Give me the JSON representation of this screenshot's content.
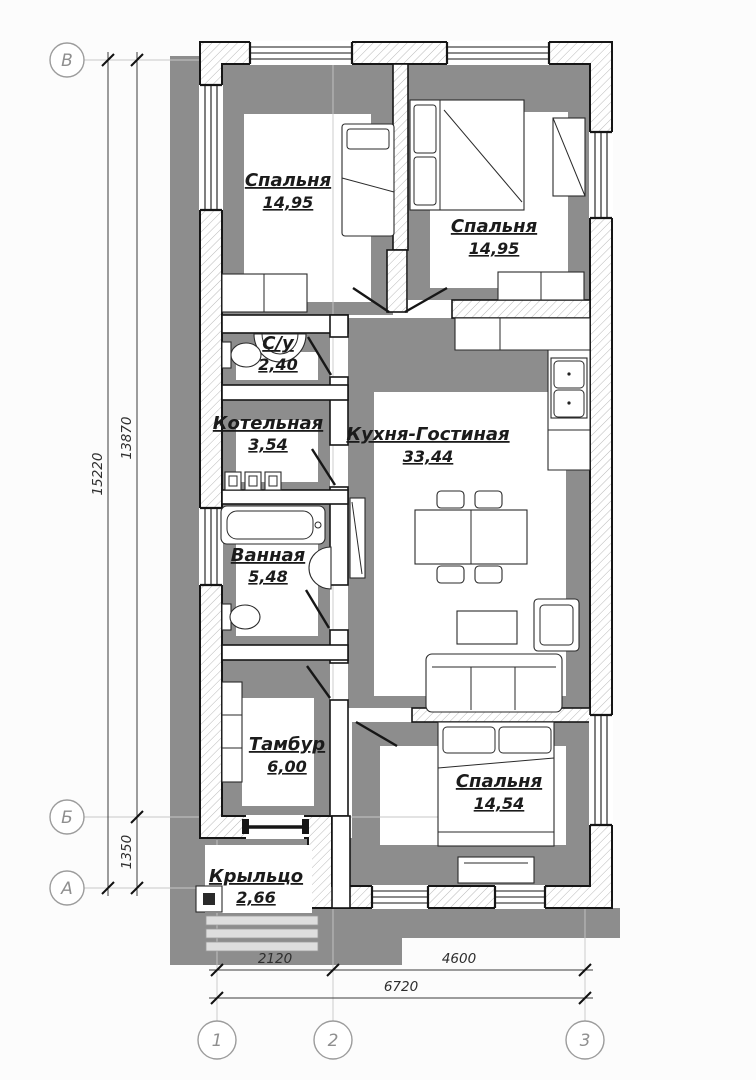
{
  "plan": {
    "rooms": [
      {
        "id": "bedroom-1",
        "name": "Спальня",
        "area": "14,95"
      },
      {
        "id": "bedroom-2",
        "name": "Спальня",
        "area": "14,95"
      },
      {
        "id": "wc",
        "name": "С/у",
        "area": "2,40"
      },
      {
        "id": "boiler-room",
        "name": "Котельная",
        "area": "3,54"
      },
      {
        "id": "kitchen-living",
        "name": "Кухня-Гостиная",
        "area": "33,44"
      },
      {
        "id": "bathroom",
        "name": "Ванная",
        "area": "5,48"
      },
      {
        "id": "vestibule",
        "name": "Тамбур",
        "area": "6,00"
      },
      {
        "id": "bedroom-3",
        "name": "Спальня",
        "area": "14,54"
      },
      {
        "id": "porch",
        "name": "Крыльцо",
        "area": "2,66"
      }
    ],
    "axis_rows": [
      "В",
      "Б",
      "А"
    ],
    "axis_cols": [
      "1",
      "2",
      "3"
    ],
    "dimensions": {
      "height_total": "15220",
      "height_main": "13870",
      "height_porch": "1350",
      "width_left": "2120",
      "width_right": "4600",
      "width_total": "6720"
    },
    "colors": {
      "shadow": "#8d8d8d",
      "line": "#161616",
      "axis_gray": "#8f8f8f",
      "background": "#fcfcfc"
    }
  }
}
